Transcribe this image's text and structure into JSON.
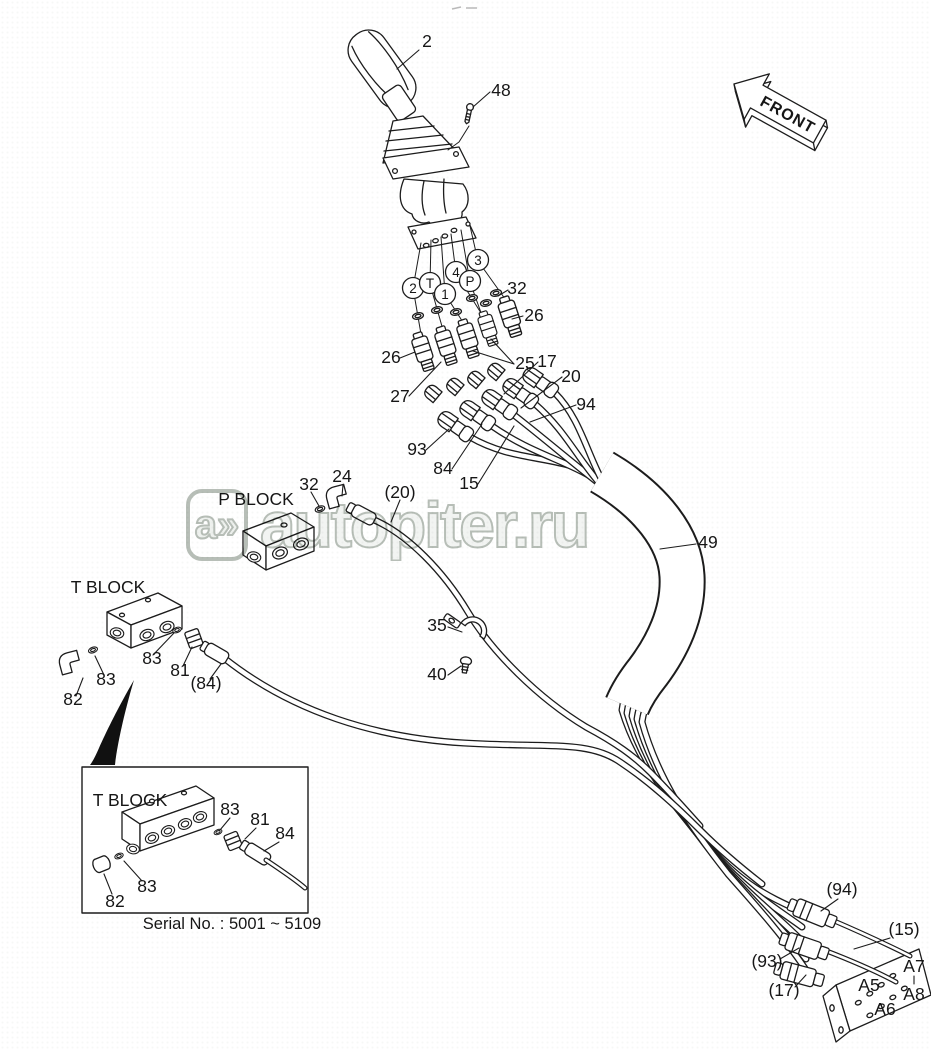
{
  "diagram": {
    "front_label": "FRONT",
    "watermark": {
      "logo_text": "a»",
      "site_text": "autopiter.ru"
    },
    "serial_note": "Serial No. : 5001 ~ 5109",
    "blocks": {
      "p": "P BLOCK",
      "t": "T BLOCK",
      "inset": "T BLOCK"
    },
    "ports": {
      "c1": "2",
      "c2": "T",
      "c3": "1",
      "c4": "4",
      "c5": "P",
      "c6": "3"
    },
    "callouts": {
      "handle": "2",
      "screw": "48",
      "oring_top": "32",
      "fit_right": "26",
      "fit_left": "26",
      "fit_27": "27",
      "fit_25": "25",
      "hose_17": "17",
      "hose_20": "20",
      "hose_94": "94",
      "hose_93": "93",
      "hose_84": "84",
      "hose_15": "15",
      "hose_20_ref": "(20)",
      "wrap_49": "49",
      "p_oring_32": "32",
      "p_elbow_24": "24",
      "t_83_left": "83",
      "t_82": "82",
      "t_83_right": "83",
      "t_81": "81",
      "t_84_ref": "(84)",
      "clamp_35": "35",
      "bolt_40": "40",
      "i_83_top": "83",
      "i_81": "81",
      "i_84": "84",
      "i_83_bot": "83",
      "i_82": "82",
      "b_94": "(94)",
      "b_15": "(15)",
      "b_93": "(93)",
      "b_17": "(17)",
      "a5": "A5",
      "a6": "A6",
      "a7": "A7",
      "a8": "A8"
    }
  }
}
